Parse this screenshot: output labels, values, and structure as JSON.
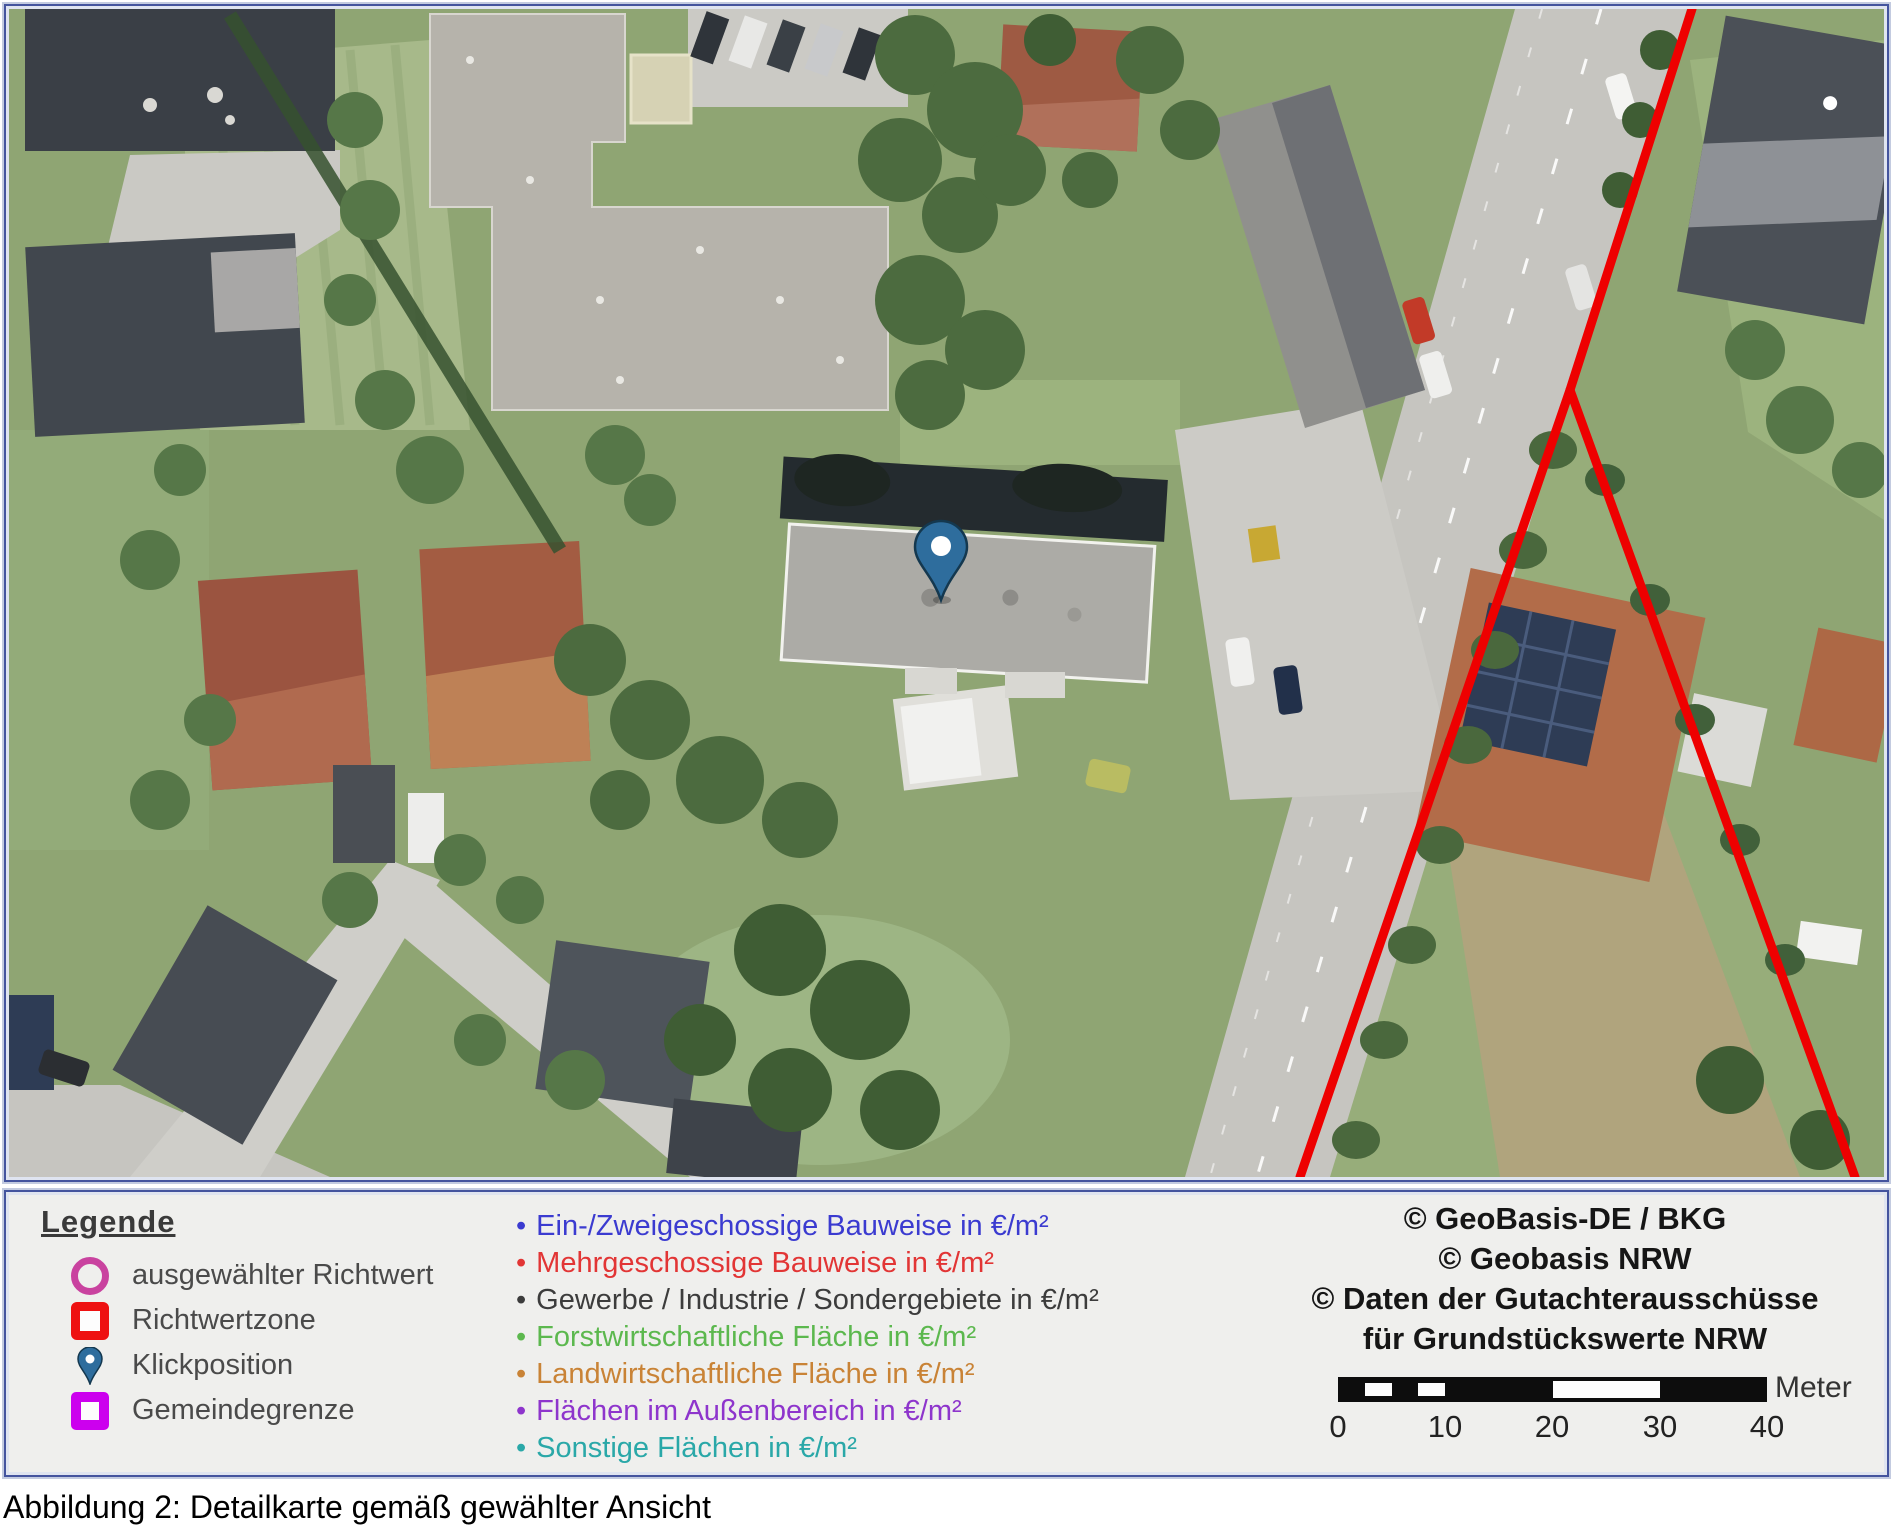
{
  "caption": "Abbildung 2: Detailkarte gemäß gewählter Ansicht",
  "map": {
    "marker": {
      "name": "Klickposition",
      "color": "#2E6D9D"
    },
    "boundary": {
      "name": "Richtwertzone",
      "color": "#EE0000"
    }
  },
  "legend": {
    "title": "Legende",
    "symbol_items": [
      {
        "symbol": "circle-outline",
        "color": "#C9429F",
        "label": "ausgewählter Richtwert"
      },
      {
        "symbol": "square-outline",
        "color": "#EE1111",
        "label": "Richtwertzone"
      },
      {
        "symbol": "map-pin",
        "color": "#2E6D9D",
        "label": "Klickposition"
      },
      {
        "symbol": "square-outline",
        "color": "#CC00EE",
        "label": "Gemeindegrenze"
      }
    ],
    "category_items": [
      {
        "color": "#3B3BD0",
        "label": "Ein-/Zweigeschossige Bauweise in €/m²"
      },
      {
        "color": "#E23535",
        "label": "Mehrgeschossige Bauweise in €/m²"
      },
      {
        "color": "#3C3C3C",
        "label": "Gewerbe / Industrie / Sondergebiete in €/m²"
      },
      {
        "color": "#5CB84E",
        "label": "Forstwirtschaftliche Fläche in €/m²"
      },
      {
        "color": "#C98336",
        "label": "Landwirtschaftliche Fläche in €/m²"
      },
      {
        "color": "#8E35CC",
        "label": "Flächen im Außenbereich in €/m²"
      },
      {
        "color": "#2AA8A8",
        "label": "Sonstige Flächen in €/m²"
      }
    ]
  },
  "attribution": {
    "lines": [
      "© GeoBasis-DE / BKG",
      "© Geobasis NRW",
      "© Daten der Gutachterausschüsse",
      "für Grundstückswerte NRW"
    ]
  },
  "scale_bar": {
    "unit": "Meter",
    "ticks": [
      "0",
      "10",
      "20",
      "30",
      "40"
    ]
  }
}
